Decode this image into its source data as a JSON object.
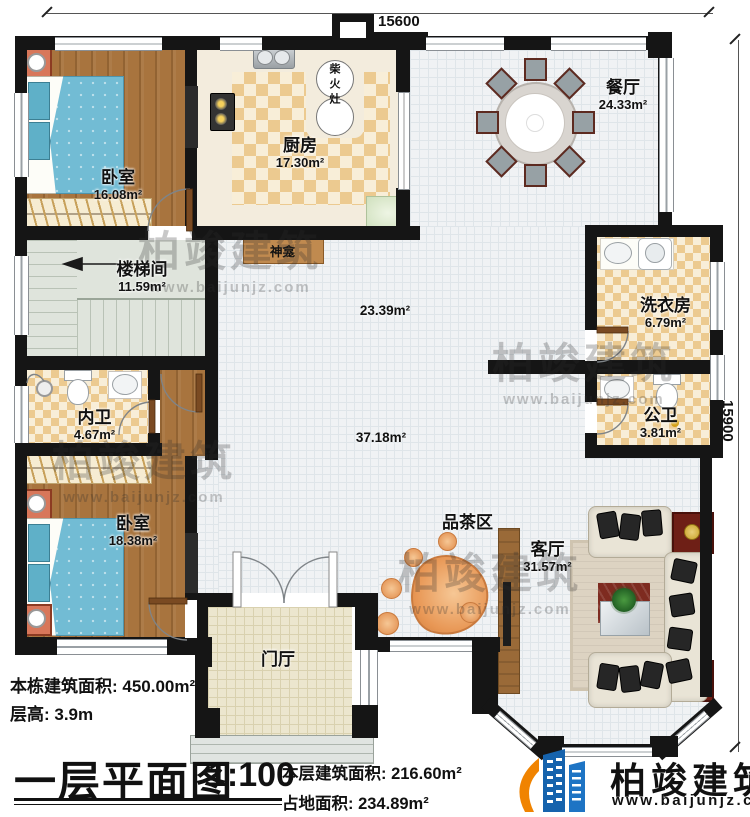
{
  "plan": {
    "dimensions": {
      "top": "15600",
      "right": "15900"
    },
    "rooms": {
      "bedroom1": {
        "name": "卧室",
        "area": "16.08m²"
      },
      "kitchen": {
        "name": "厨房",
        "area": "17.30m²"
      },
      "dining": {
        "name": "餐厅",
        "area": "24.33m²"
      },
      "stairwell": {
        "name": "楼梯间",
        "area": "11.59m²"
      },
      "laundry": {
        "name": "洗衣房",
        "area": "6.79m²"
      },
      "bath_inner": {
        "name": "内卫",
        "area": "4.67m²"
      },
      "bath_public": {
        "name": "公卫",
        "area": "3.81m²"
      },
      "bedroom2": {
        "name": "卧室",
        "area": "18.38m²"
      },
      "living": {
        "name": "客厅",
        "area": "31.57m²"
      },
      "tea": {
        "name": "品茶区"
      },
      "foyer": {
        "name": "门厅"
      },
      "shrine": {
        "name": "神龛"
      },
      "stove": {
        "name": "柴火灶"
      }
    },
    "open_areas": {
      "upper": "23.39m²",
      "lower": "37.18m²"
    }
  },
  "footer": {
    "building_total": "本栋建筑面积: 450.00m²",
    "floor_height": "层高: 3.9m",
    "plan_title": "一层平面图",
    "scale": "1:100",
    "floor_area": "本层建筑面积: 216.60m²",
    "land_area": "占地面积: 234.89m²"
  },
  "brand": {
    "name": "柏竣建筑",
    "url": "www.baijunjz.com"
  },
  "colors": {
    "wall": "#151515",
    "accent_blue": "#1663ad",
    "accent_orange": "#f08300"
  }
}
